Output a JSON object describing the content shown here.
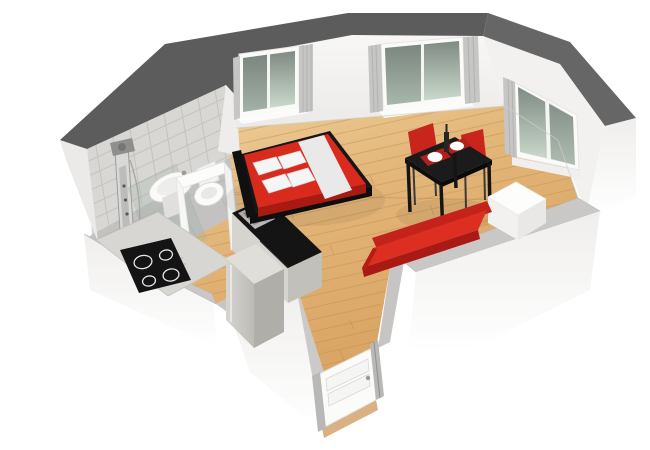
{
  "scene": {
    "kind": "3d-floorplan-render",
    "description": "Isometric cutaway 3D floor plan of a studio apartment on a white background",
    "rooms": [
      "bathroom",
      "kitchen",
      "living-bedroom-area",
      "entry-hallway"
    ],
    "objects": [
      {
        "name": "shower-column",
        "room": "bathroom"
      },
      {
        "name": "wall-sink",
        "room": "bathroom"
      },
      {
        "name": "toilet",
        "room": "bathroom"
      },
      {
        "name": "glass-shower-screen",
        "room": "bathroom"
      },
      {
        "name": "bathroom-door-frame",
        "room": "bathroom"
      },
      {
        "name": "cooktop-4-burners",
        "room": "kitchen"
      },
      {
        "name": "kitchen-island-with-sink",
        "room": "kitchen"
      },
      {
        "name": "tall-cabinet-fridge",
        "room": "kitchen"
      },
      {
        "name": "double-bed-red-white",
        "room": "living-bedroom-area"
      },
      {
        "name": "dining-table-black",
        "room": "living-bedroom-area"
      },
      {
        "name": "red-chairs",
        "count": 2,
        "room": "living-bedroom-area"
      },
      {
        "name": "place-settings",
        "count": 2,
        "room": "living-bedroom-area"
      },
      {
        "name": "red-sofa-bench",
        "room": "living-bedroom-area"
      },
      {
        "name": "white-side-table",
        "room": "living-bedroom-area"
      },
      {
        "name": "window",
        "count": 3,
        "room": "living-bedroom-area"
      },
      {
        "name": "entry-door-white",
        "room": "entry-hallway"
      }
    ],
    "colors": {
      "background": "#ffffff",
      "tall_wall_top": "#5c5c5c",
      "low_wall_top": "#c9c8c7",
      "interior_wall": "#f6f5f3",
      "wood_floor": "#dfae6e",
      "bathroom_tile": "#d8d7d4",
      "accent_red": "#d92a1e",
      "furniture_black": "#161616",
      "window_glass_top": "#7f8a83",
      "window_glass_bottom": "#cfdfd2",
      "curtain_gray": "#c6c6c5",
      "steel_gray": "#b9b8b6"
    }
  }
}
